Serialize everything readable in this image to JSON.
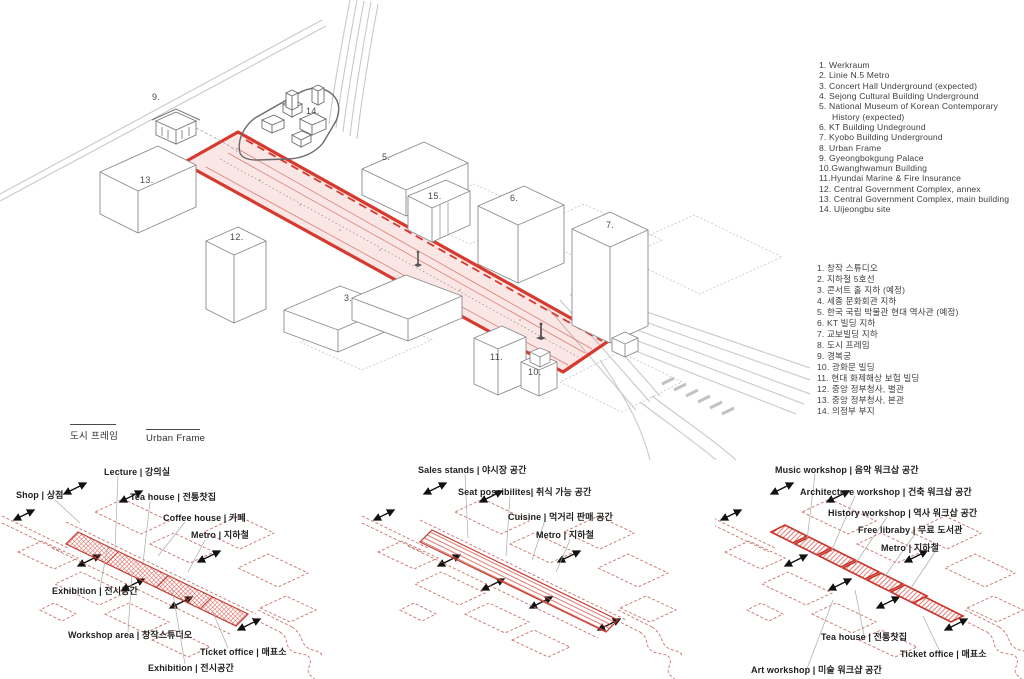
{
  "main": {
    "callouts": [
      "9.",
      "14.",
      "13.",
      "12.",
      "5.",
      "15.",
      "6.",
      "7.",
      "3.",
      "11.",
      "10."
    ]
  },
  "frame_key": {
    "ko": "도시 프레임",
    "en": "Urban Frame"
  },
  "legend_en": {
    "items": [
      "1. Werkraum",
      "2. Linie N.5 Metro",
      "3. Concert Hall Underground (expected)",
      "4. Sejong Cultural Building Underground",
      "5. National Museum of Korean Contemporary History (expected)",
      "6. KT Building Undeground",
      "7. Kyobo Building Underground",
      "8. Urban Frame",
      "9. Gyeongbokgung Palace",
      "10.Gwanghwamun Building",
      "11.Hyundai Marine & Fire Insurance",
      "12. Central Government Complex, annex",
      "13. Central Government Complex, main building",
      "14. Uijeongbu site"
    ]
  },
  "legend_ko": {
    "items": [
      "1. 창작 스튜디오",
      "2. 지하철 5호선",
      "3. 콘서트 홀 지하 (예정)",
      "4. 세종 문화회관 지하",
      "5. 한국 국립 박물관 현대 역사관 (예정)",
      "6. KT 빌딩 지하",
      "7. 교보빌딩 지하",
      "8. 도시 프레임",
      "9. 경복궁",
      "10. 광화문 빌딩",
      "11. 현대 화제해상 보험 빌딩",
      "12. 중앙 정부청사, 별관",
      "13. 중앙 정부청사, 본관",
      "14. 의정부 부지"
    ]
  },
  "diagrams": {
    "left": {
      "lecture": "Lecture | 강의실",
      "shop": "Shop | 상점",
      "tea_house": "Tea house | 전통찻집",
      "coffee_house": "Coffee house | 카페",
      "metro": "Metro | 지하철",
      "exhibition_upper": "Exhibition | 전시공간",
      "workshop_area": "Workshop area | 창작스튜디오",
      "ticket_office": "Ticket office | 매표소",
      "exhibition_lower": "Exhibition | 전시공간"
    },
    "middle": {
      "sales_stands": "Sales stands | 야시장 공간",
      "seat_possibilities": "Seat possibilites| 취식 가능 공간",
      "cuisine": "Cuisine | 먹거리 판매 공간",
      "metro": "Metro | 지하철"
    },
    "right": {
      "music_workshop": "Music workshop | 음악 워크삽 공간",
      "architecture_workshop": "Architecture workshop | 건축 워크삽 공간",
      "history_workshop": "History workshop | 역사 워크삽 공간",
      "free_library": "Free libraby | 무료 도서관",
      "metro": "Metro | 지하철",
      "tea_house": "Tea house | 전통찻집",
      "ticket_office": "Ticket office | 매표소",
      "art_workshop": "Art workshop | 미술 워크샵 공간"
    }
  },
  "colors": {
    "accent_red": "#d63a2f",
    "hatch_red": "#d9574d",
    "plot_outline": "#c4756a",
    "frame_fill": "rgba(214,58,47,0.13)"
  }
}
